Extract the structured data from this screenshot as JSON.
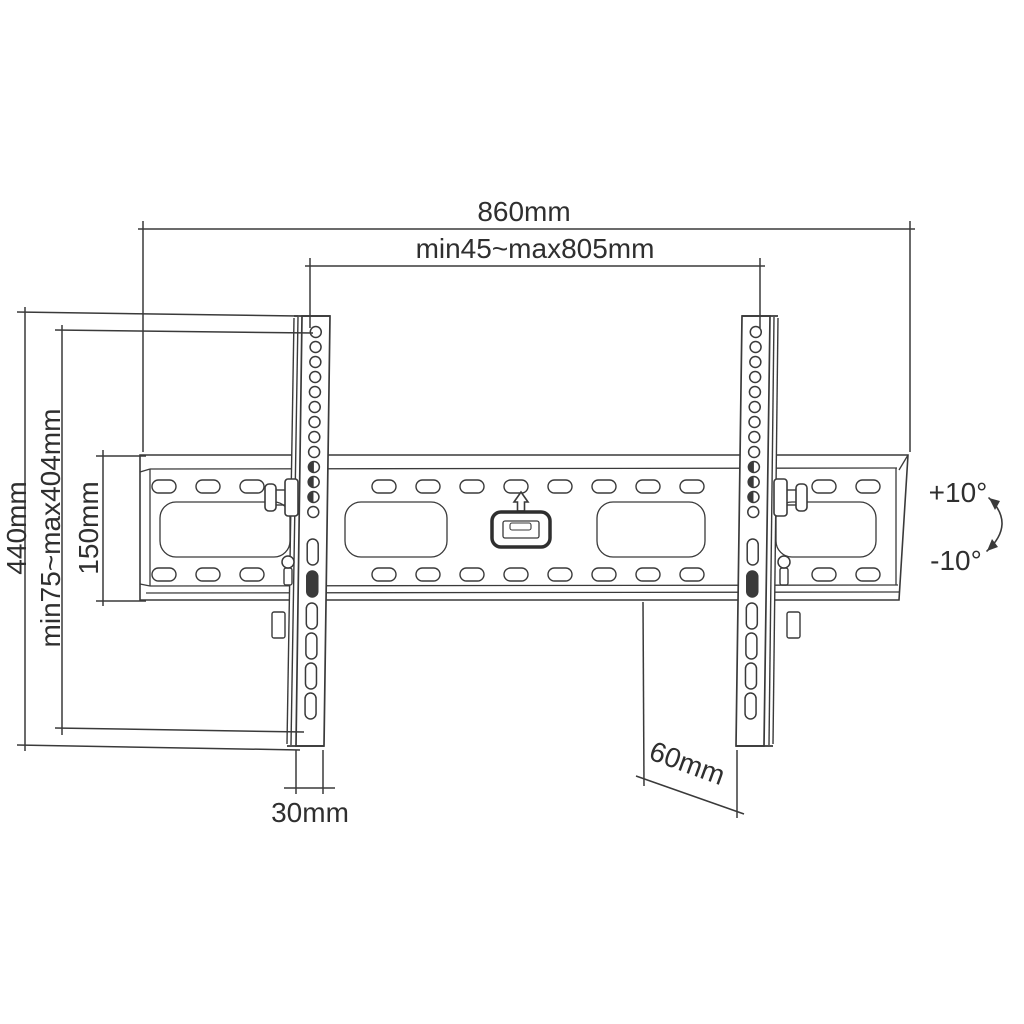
{
  "diagram": {
    "title": "Tilting TV wall mount - dimensional line drawing",
    "labels": {
      "overall_width": "860mm",
      "horizontal_adjustment": "min45~max805mm",
      "bracket_height": "440mm",
      "vesa_vertical_range": "min75~max404mm",
      "wall_plate_height": "150mm",
      "bracket_width": "30mm",
      "wall_clearance": "60mm",
      "tilt_up": "+10°",
      "tilt_down": "-10°"
    },
    "icons": {
      "up_arrow": "up-arrow-icon",
      "level": "level-indicator",
      "tilt_arc": "tilt-arc-arrow-icon"
    },
    "colors": {
      "line": "#3a3a3a",
      "text": "#2f2f2f",
      "background": "#ffffff"
    }
  }
}
